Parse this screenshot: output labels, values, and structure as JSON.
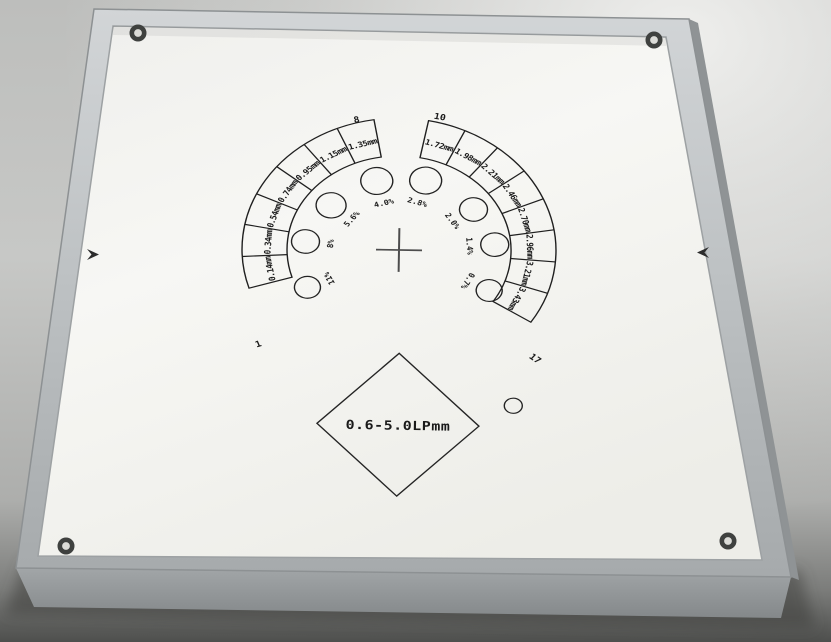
{
  "phantom": {
    "diamond_label": "0.6-5.0LPmm",
    "markers": [
      {
        "name": "group-1",
        "label": "1"
      },
      {
        "name": "group-8",
        "label": "8"
      },
      {
        "name": "group-10",
        "label": "10"
      },
      {
        "name": "group-17",
        "label": "17"
      }
    ],
    "left_segments": [
      {
        "label": "1.35mm"
      },
      {
        "label": "1.15mm"
      },
      {
        "label": "0.95mm"
      },
      {
        "label": "0.74mm"
      },
      {
        "label": "0.54mm"
      },
      {
        "label": "0.34mm"
      },
      {
        "label": "0.14mm"
      }
    ],
    "right_segments": [
      {
        "label": "1.72mm"
      },
      {
        "label": "1.98mm"
      },
      {
        "label": "2.21mm"
      },
      {
        "label": "2.46mm"
      },
      {
        "label": "2.70mm"
      },
      {
        "label": "2.96mm"
      },
      {
        "label": "3.21mm"
      },
      {
        "label": "3.43mm"
      }
    ],
    "contrast_circles": [
      {
        "label": "4.0%"
      },
      {
        "label": "2.8%"
      },
      {
        "label": "5.6%"
      },
      {
        "label": "8%"
      },
      {
        "label": "11%"
      },
      {
        "label": "2.0%"
      },
      {
        "label": "1.4%"
      },
      {
        "label": "0.7%"
      }
    ],
    "colors": {
      "panel": "#f5f5f2",
      "frame": "#b9bdbf",
      "ink": "#1a1a1a",
      "background": "#c7c8c6",
      "shadow": "#3a3b39"
    }
  }
}
